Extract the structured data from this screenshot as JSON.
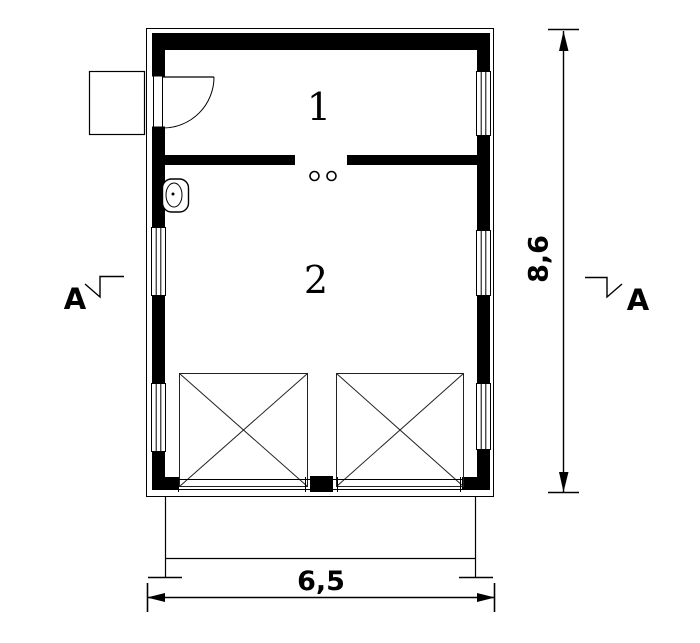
{
  "drawing": {
    "type": "architectural-floor-plan",
    "rooms": [
      {
        "label": "1"
      },
      {
        "label": "2"
      }
    ],
    "dimensions": {
      "height_label": "8,6",
      "width_label": "6,5"
    },
    "section_markers": {
      "left_label": "A",
      "right_label": "A"
    },
    "symbols": [
      "entry-door-with-swing",
      "porch",
      "toilet",
      "partition-door-posts",
      "window-left-1",
      "window-left-2",
      "window-right-1",
      "window-right-2",
      "window-right-3",
      "garage-door-left",
      "garage-door-right",
      "driveway"
    ],
    "colors": {
      "ink": "#000000",
      "background": "#ffffff"
    }
  }
}
